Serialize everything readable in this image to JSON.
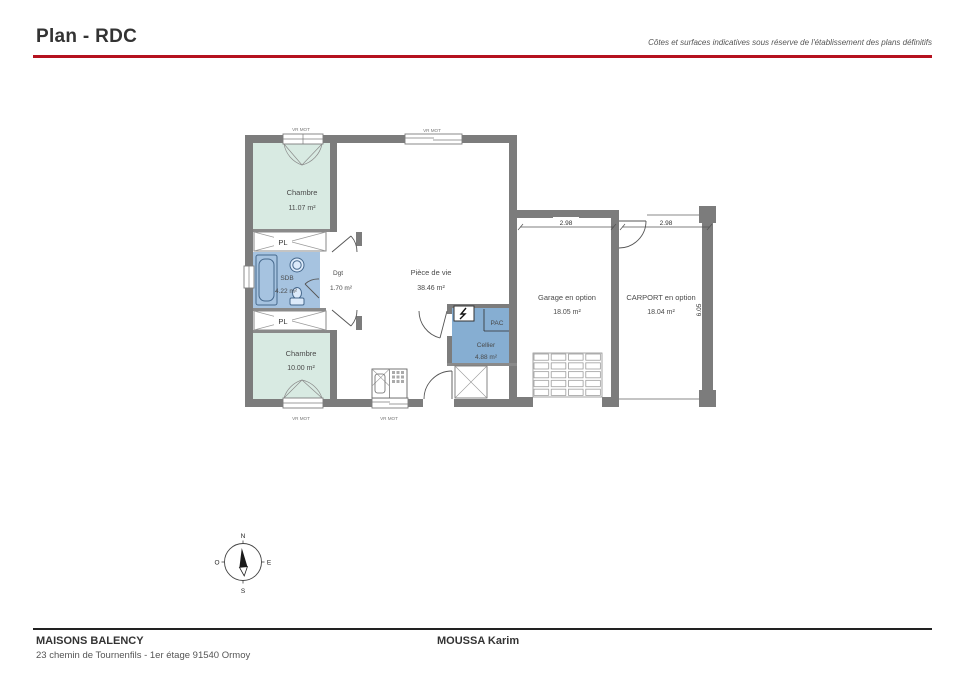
{
  "header": {
    "title": "Plan - RDC",
    "disclaimer": "Côtes et surfaces indicatives sous réserve de l'établissement des plans définitifs"
  },
  "plan": {
    "rooms": {
      "chambre1": {
        "label": "Chambre",
        "area": "11.07 m²"
      },
      "chambre2": {
        "label": "Chambre",
        "area": "10.00 m²"
      },
      "pl_top": {
        "label": "PL"
      },
      "pl_bottom": {
        "label": "PL"
      },
      "sdb": {
        "label": "SDB",
        "area": "4.22 m²"
      },
      "dgt": {
        "label": "Dgt",
        "area": "1.70 m²"
      },
      "piece_de_vie": {
        "label": "Pièce de vie",
        "area": "38.46 m²"
      },
      "cellier": {
        "label": "Cellier",
        "area": "4.88 m²"
      },
      "pac": {
        "label": "PAC"
      },
      "garage": {
        "label": "Garage en option",
        "area": "18.05 m²"
      },
      "carport": {
        "label": "CARPORT en option",
        "area": "18.04 m²"
      }
    },
    "window_label": "VR MOT",
    "dimensions": {
      "garage_width": "2.98",
      "carport_width": "2.98",
      "carport_depth": "6.05"
    },
    "compass": {
      "n": "N",
      "s": "S",
      "e": "E",
      "o": "O"
    }
  },
  "footer": {
    "company": "MAISONS BALENCY",
    "address": "23 chemin de Tournenfils - 1er étage 91540 Ormoy",
    "client": "MOUSSA Karim"
  },
  "colors": {
    "accent_red": "#b5121f",
    "wall_gray": "#7c7c7c",
    "bedroom_fill": "#d8eae2",
    "bathroom_fill": "#a6c3e0",
    "cellier_fill": "#86aed2"
  }
}
